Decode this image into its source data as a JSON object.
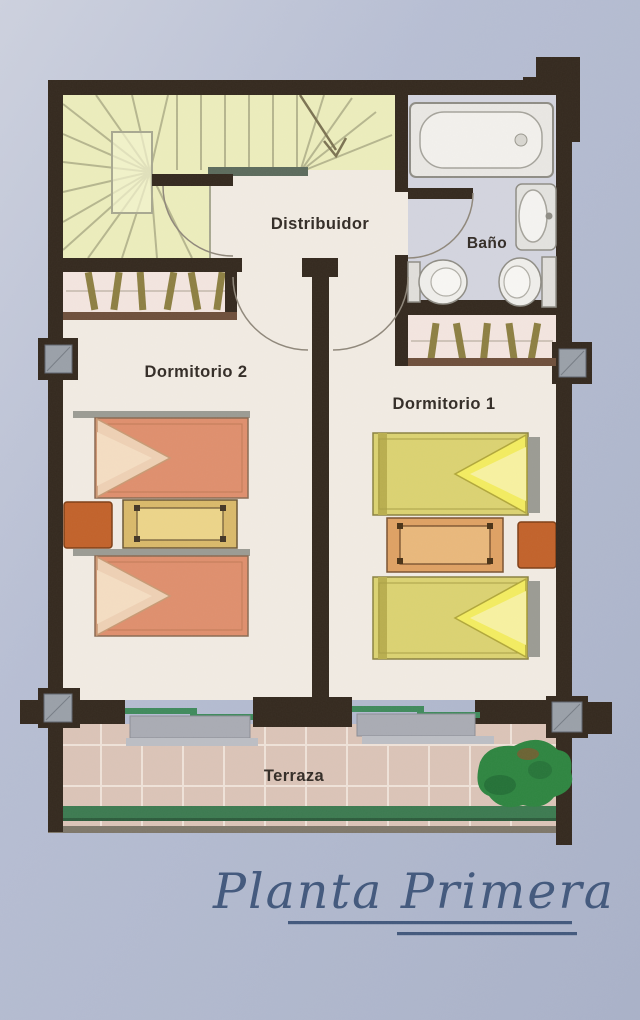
{
  "title": {
    "text": "Planta Primera"
  },
  "plan": {
    "rooms": {
      "distribuidor": {
        "label": "Distribuidor"
      },
      "bano": {
        "label": "Baño"
      },
      "dormitorio2": {
        "label": "Dormitorio 2"
      },
      "dormitorio1": {
        "label": "Dormitorio 1"
      },
      "terraza": {
        "label": "Terraza"
      }
    },
    "fixtures": [
      "staircase",
      "wardrobe",
      "bathtub",
      "washbasin",
      "toilet",
      "bidet",
      "twin-bed",
      "nightstand",
      "stool",
      "sliding-window",
      "pillar",
      "plant",
      "door-swing"
    ],
    "palette": {
      "paper_blue": "#b6bdd2",
      "wall": "#34291e",
      "stairs": "#ecedbc",
      "bath_floor": "#d3d4de",
      "closet_floor": "#f3e5df",
      "bedroom_floor": "#f1ebe2",
      "terrace_tile": "#dbc4b7",
      "bed_orange": "#df8f6d",
      "bed_fold_orange": "#eed0b4",
      "bed_yellow": "#dbd271",
      "bed_fold_yellow": "#f3ec60",
      "nightstand_tan": "#d9b96a",
      "nightstand_orange": "#dfa163",
      "stool_orange": "#c2622a",
      "hanger": "#8d7f42",
      "railing_green": "#3c7a50",
      "plant_green": "#2e8540",
      "pillar_gray": "#9aa0a8",
      "title_blue": "#42587c"
    }
  }
}
